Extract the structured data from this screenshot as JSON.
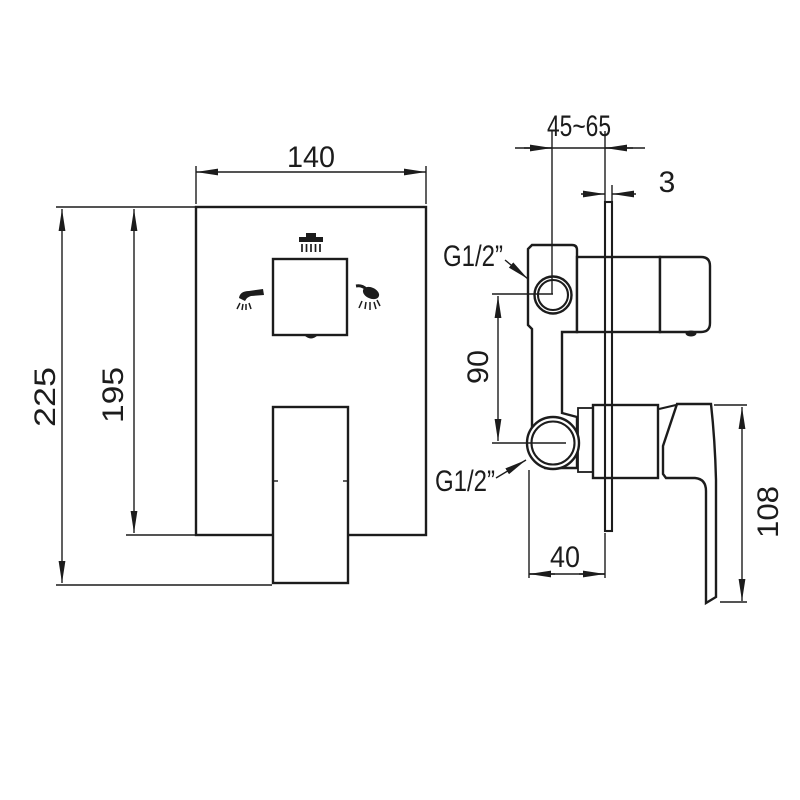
{
  "page": {
    "background": "#ffffff",
    "line_color": "#1c1c1c",
    "description": "technical dimension drawing of concealed shower mixer valve, front and side views"
  },
  "front_view": {
    "dimensions": {
      "width": "140",
      "total_height": "225",
      "plate_height": "195"
    },
    "icons": {
      "top": "rain-shower-icon",
      "left": "spout-icon",
      "right": "hand-shower-icon"
    }
  },
  "side_view": {
    "dimensions": {
      "install_depth_range": "45~65",
      "plate_thickness": "3",
      "port_spacing": "90",
      "body_to_plate": "40",
      "handle_height": "108"
    },
    "connections": {
      "top": "G1/2”",
      "bottom": "G1/2”"
    }
  }
}
